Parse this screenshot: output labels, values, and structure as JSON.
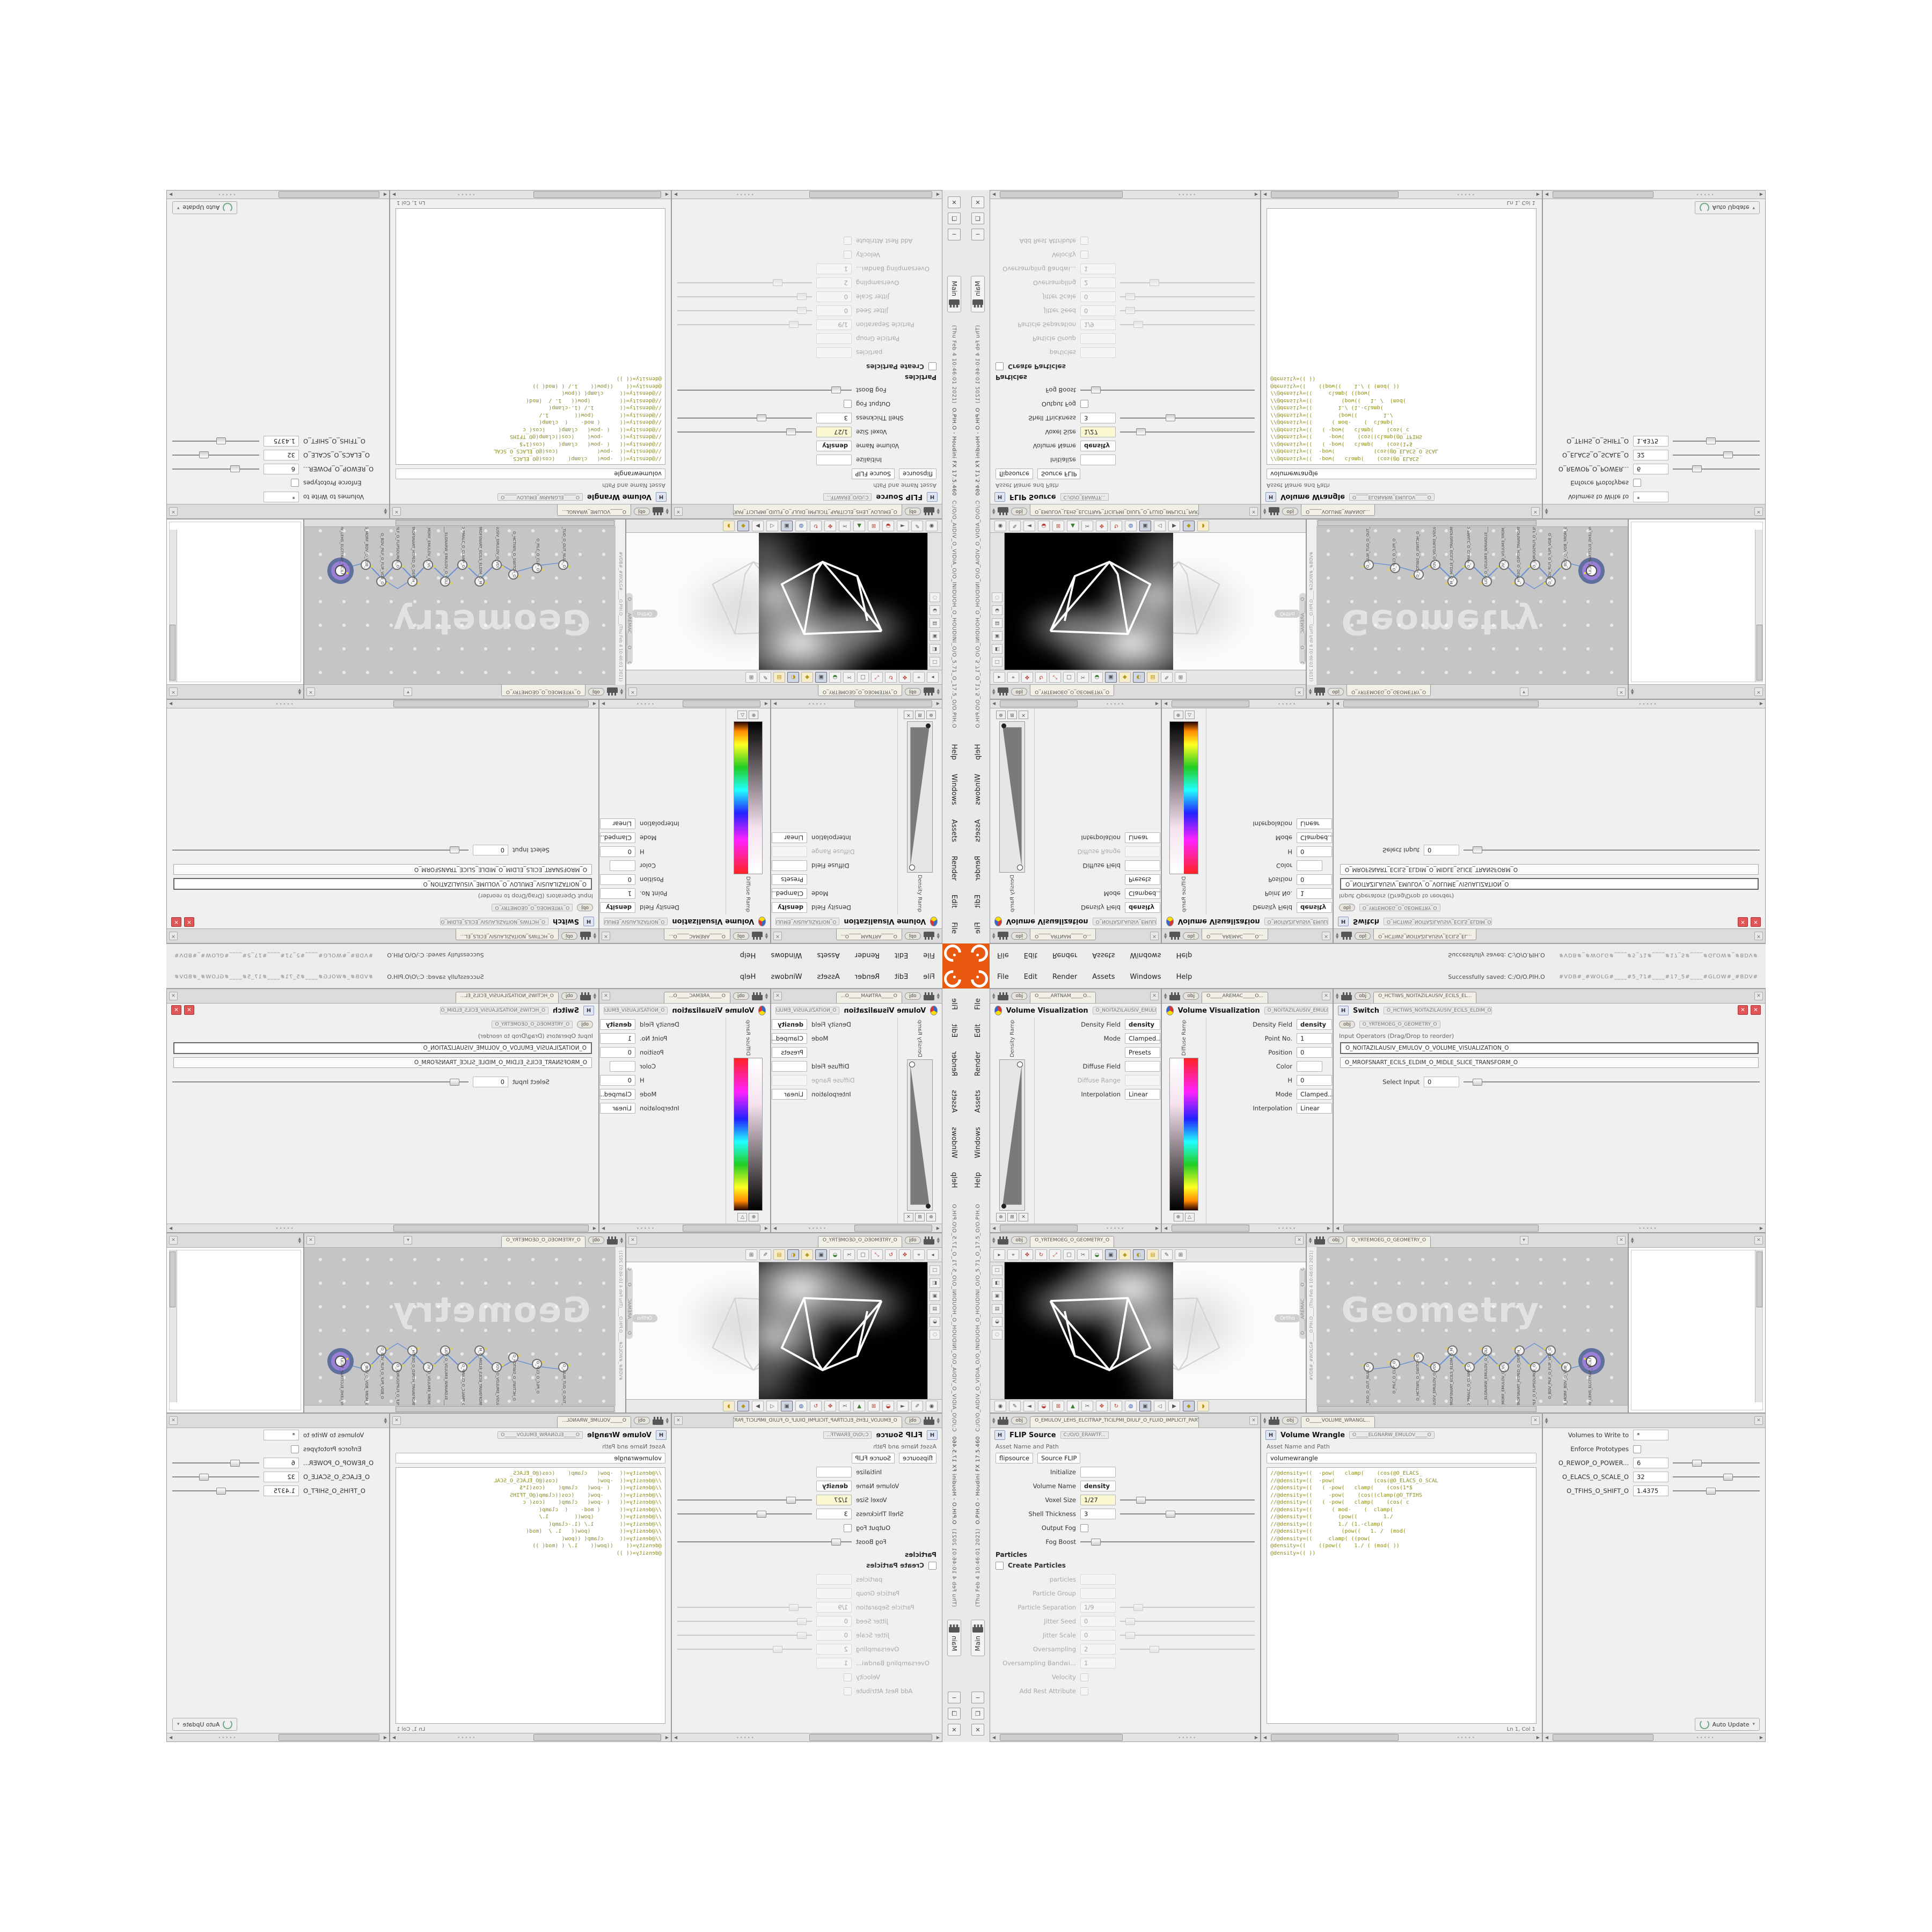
{
  "colors": {
    "accent_orange": "#e8590f",
    "selection_purple": "#9a7fd6",
    "selection_ring_slate": "#5f6f9e",
    "wire_blue": "#6b8fd4",
    "code_olive": "#8d8d1d",
    "field_yellow": "#fbf8d2",
    "network_bg": "#c5c5c5",
    "viewport_black": "#000000",
    "close_red": "#e05555"
  },
  "ui": {
    "menu": [
      "File",
      "Edit",
      "Render",
      "Assets",
      "Windows",
      "Help"
    ],
    "window_buttons": [
      "−",
      "❐",
      "✕"
    ],
    "desktop_tab": "Main",
    "title_path": "C:/O/O_AIDIV_O_VIDIA_O/O_INIDUOH_O_HOUDINI_O/O_5.71_O_17.5_O/O.PIH.O",
    "title_app": "O.PIH.O - Houdini FX 17.5.460",
    "title_time": "(Thu Feb 4 10:46:01 2021)",
    "status_saved": "Successfully saved: C:/O/O.PIH.O",
    "status_tags": "#VDB#_#WOLG#____#5_71#____#17_5#____#GLOW#_#BDV#",
    "obj_badge": "obj",
    "grip": "∙∙∙∙∙",
    "up_arrow": "▲",
    "down_arrow": "▼",
    "left_arrow": "◀",
    "right_arrow": "▶",
    "close_glyph": "✕",
    "pin_glyph": "▾"
  },
  "ramp": {
    "tab_a": "O_____ARTNAM_____O...",
    "tab_b": "O_____AREMAC_____O...",
    "title": "Volume Visualization",
    "chip": "O_NOITAZILAUSIV_EMULOV____O",
    "density_ramp_label": "Density Ramp",
    "diffuse_ramp_label": "Diffuse Ramp",
    "density_field_label": "Density Field",
    "density_value": "density",
    "mode_label": "Mode",
    "mode_value": "Clamped...",
    "presets_label": "Presets",
    "diffuse_field_label": "Diffuse Field",
    "diffuse_range_label": "Diffuse Range",
    "point_no_label": "Point No.",
    "point_no_value": "1",
    "position_label": "Position",
    "position_value": "0",
    "color_label": "Color",
    "h_label": "H",
    "h_value": "0",
    "s_label": "S",
    "s_value": "0",
    "v_label": "V",
    "v_value": "1.8125",
    "interp_label": "Interpolation",
    "interp_value": "Linear",
    "btn_add": "⊕",
    "btn_grid": "⊞",
    "btn_del": "✕",
    "btn_tri": "△"
  },
  "switch": {
    "tab": "O_HCTIWS_NOITAZILAUSIV_ECILS_EL...",
    "title": "Switch",
    "chip": "O_HCTIWS_NOITAZILAUSIV_ECILS_ELDIM_O",
    "breadcrumb": "O_YRTEMOEG_O_GEOMETRY_O",
    "input_ops": "Input Operators (Drag/Drop to reorder)",
    "items": [
      "O_NOITAZILAUSIV_EMULOV_O_VOLUME_VISUALIZATION_O",
      "O_MROFSNART_ECILS_ELDIM_O_MIDLE_SLICE_TRANSFORM_O"
    ],
    "select_input_label": "Select Input",
    "select_input_value": "0"
  },
  "viewport": {
    "tab": "O_YRTEMOEG_O_GEOMETRY_O",
    "camera_pill": "O_____AREMAC_____O_____CAMERA_____O",
    "ortho": "Ortho",
    "toolbar_glyphs": [
      "▸",
      "⌖",
      "✥",
      "↻",
      "⤢",
      "□",
      "✂",
      "◒",
      "▣",
      "◆",
      "◐",
      "▤",
      "✎",
      "⊞"
    ],
    "side_glyphs": [
      "□",
      "◧",
      "▣",
      "▤",
      "◒",
      "◌"
    ],
    "snap_glyphs": [
      "◉",
      "✎",
      "◄",
      "◒",
      "⊞",
      "▲",
      "✂",
      "✥",
      "↻",
      "◍",
      "▣",
      "◁",
      "▶",
      "◆",
      "◗"
    ]
  },
  "network": {
    "breadcrumb": "O_YRTEMOEG_O_GEOMETRY_O",
    "watermark": "Geometry",
    "echo_tags": "#VDB#_#WOLG#____O.PIH.O____(Thu Feb 4 10:46:01 2021)",
    "nodes": [
      {
        "label": "O_EMULOV_LEHS_ELCITRAP_TICILPMI_DIULF_O",
        "x": 88,
        "y": 68
      },
      {
        "label": "O_YRTEMOEG_MORF_BDV_O_VDB_FROM_GEOMETRY_O",
        "x": 80,
        "y": 72
      },
      {
        "label": "O_BDV_PILF_O_FLIP_VDB_O",
        "x": 75,
        "y": 62
      },
      {
        "label": "O_ECRUOSPILF_O_FLIPSOURCE_O",
        "x": 70,
        "y": 72
      },
      {
        "label": "O_MROFSNART_HTPED_O_DEPTH_TRANSFORM_O",
        "x": 65,
        "y": 62
      },
      {
        "label": "O_ECAFRUS_MORF_EMULOV_O_VOLUME_FROM_SURFACE_O",
        "x": 60,
        "y": 72
      },
      {
        "label": "O_____ELGNARW_EMULOV_O_VOLUME_WRANGLE_____O",
        "x": 54.5,
        "y": 62
      },
      {
        "label": "O_PMALC_O_CLAMP_O",
        "x": 49,
        "y": 72
      },
      {
        "label": "O_MROFSNART_ECILS_ELDIM_O_MIDLE_SLICE_TRANSFORM_O",
        "x": 43.5,
        "y": 62
      },
      {
        "label": "O_NOITAZILAUSIV_EMULOV_O_VOLUME_VISUALIZATION_O",
        "x": 38,
        "y": 72
      },
      {
        "label": "O_HCTIWS_O_SWITCH_O",
        "x": 32.5,
        "y": 66
      },
      {
        "label": "O_PILC_O_CLIP_O",
        "x": 25,
        "y": 70
      },
      {
        "label": "O_LLUN_TUO_O_OUT_NULL_O",
        "x": 16.5,
        "y": 72
      }
    ]
  },
  "flip": {
    "tab": "O_EMULOV_LEHS_ELCITRAP_TICILPMI_DIULF_O_FLUID_IMPLICIT_PARTI...",
    "title": "FLIP Source",
    "type_value": "flipsource",
    "input_value": "Source FLIP",
    "path_value": "C:/O/O_ERAWTF...",
    "asset_label": "Asset Name and Path",
    "rows": [
      {
        "l": "Initialize",
        "v": ""
      },
      {
        "l": "Volume Name",
        "v": "density"
      },
      {
        "l": "Voxel Size",
        "v": "1/27"
      },
      {
        "l": "Shell Thickness",
        "v": "3"
      },
      {
        "l": "Output Fog",
        "v": ""
      },
      {
        "l": "Fog Boost",
        "v": ""
      }
    ],
    "particles_section": "Particles",
    "create_particles": "Create Particles",
    "grayed": [
      {
        "l": "particles",
        "v": ""
      },
      {
        "l": "Particle Group",
        "v": ""
      },
      {
        "l": "Particle Separation",
        "v": "1/9"
      },
      {
        "l": "Jitter Seed",
        "v": "0"
      },
      {
        "l": "Jitter Scale",
        "v": "0"
      },
      {
        "l": "Oversampling",
        "v": "2"
      },
      {
        "l": "Oversampling Bandwi...",
        "v": "1"
      },
      {
        "l": "Velocity",
        "v": ""
      },
      {
        "l": "Add Rest Attribute",
        "v": ""
      }
    ]
  },
  "wrangle": {
    "tab": "O_____VOLUME_WRANGL...",
    "title": "Volume Wrangle",
    "chip": "O_____ELGNARW_EMULOV_____O",
    "type_value": "volumewrangle",
    "asset_label": "Asset Name and Path",
    "status": "Ln 1, Col 1",
    "code": [
      "//@density=((  -pow(   clamp(    (cos(@O_ELACS_",
      "//@density=((  -pow(            (cos(@O_ELACS_O_SCAL",
      "//@density=((   ( -pow(   clamp(    (cos(1*$",
      "//@density=((     -pow(    (cos((clamp(@O_TFIHS",
      "//@density=((   ( -pow(   clamp(    (cos( c",
      "//@density=((      ( mod-    (  clamp(",
      "//@density=((        (pow((        1./",
      "//@density=((        1./ (1.-clamp(",
      "//@density=((         (pow((   1. /  (mod(",
      "//@density=((     clamp( ((pow(",
      "@density=((    ((pow((    1./ ( (mod( ))",
      "@density=(( ))"
    ]
  },
  "sliders": {
    "volumes_label": "Volumes to Write to",
    "volumes_value": "*",
    "enforce_label": "Enforce Prototypes",
    "params": [
      {
        "l": "O_REWOP_O_POWER...",
        "v": "6"
      },
      {
        "l": "O_ELACS_O_SCALE_O",
        "v": "32"
      },
      {
        "l": "O_TFIHS_O_SHIFT_O",
        "v": "1.4375"
      }
    ],
    "auto_update": "Auto Update"
  }
}
